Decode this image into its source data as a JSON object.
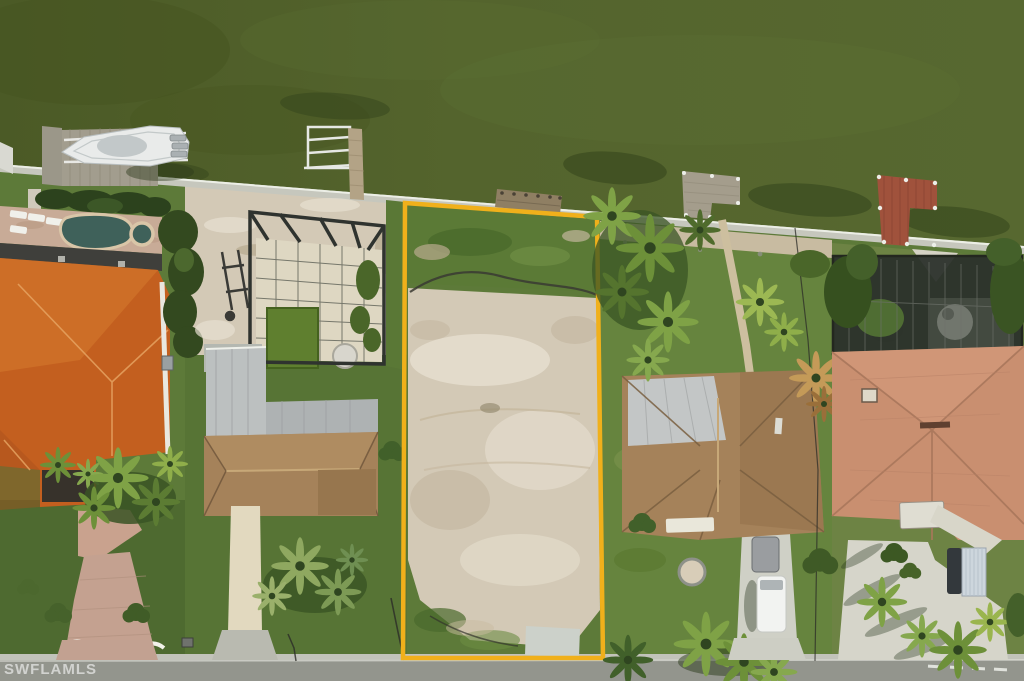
{
  "watermark": {
    "text": "SWFLAMLS"
  },
  "scene": {
    "description": "aerial-photo-vacant-waterfront-lot",
    "lot_outline_shape": "rectangle",
    "water_position": "top",
    "road_position": "bottom"
  },
  "colors": {
    "water": "#52622c",
    "water_light": "#5d7035",
    "water_dark": "#46531f",
    "shore_shadow": "#33431b",
    "seawall": "#c6c7bd",
    "seawall_cap": "#eceee6",
    "grass": "#5d7a39",
    "grass_dark": "#48642c",
    "grass_light": "#75914a",
    "sand": "#d3c9b6",
    "sand_light": "#e7e0d1",
    "sand_dark": "#bfb29a",
    "lot_outline": "#f0b01b",
    "pool_water": "#3f615a",
    "cage_pool_green": "#5f7f2f",
    "paver": "#c8ab97",
    "concrete": "#cfd0c6",
    "road": "#93958d",
    "gutter": "#c2c3ba",
    "roof_orange": "#c35f1f",
    "roof_orange_light": "#d67a2e",
    "roof_brown": "#a5825a",
    "roof_salmon": "#c98f70",
    "roof_metal": "#bcc0c0",
    "dock_wood": "#a49d8c",
    "dock_red": "#a0523c",
    "boat_white": "#e9ebea",
    "screen_dark": "#2b302a",
    "tree_green": "#3d5a26",
    "palm_light": "#86a84e",
    "watermark": "#ffffff"
  }
}
